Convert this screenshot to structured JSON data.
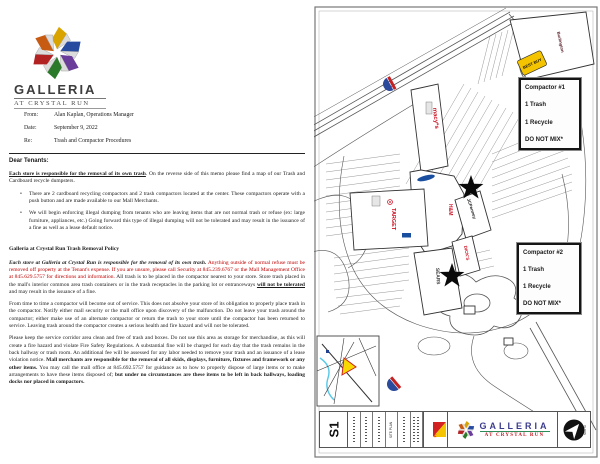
{
  "colors": {
    "memo_red": "#c00000",
    "store_red": "#cc1122",
    "label_blue": "#1a4fa0",
    "bestbuy_yellow": "#f5c400",
    "shield_blue": "#2b4a9b",
    "shield_red": "#c42222",
    "galleria_blue": "#3c3c8e",
    "galleria_green": "#2e8b57",
    "crystal_run_red": "#c01820",
    "pyramid_red": "#d42222",
    "pyramid_yellow": "#f5c400"
  },
  "memo": {
    "logo": {
      "name": "GALLERIA",
      "tagline": "AT CRYSTAL RUN"
    },
    "fields": {
      "from_label": "From:",
      "from": "Alan Kaplan, Operations Manager",
      "date_label": "Date:",
      "date": "September 9, 2022",
      "re_label": "Re:",
      "re": "Trash and Compactor Procedures"
    },
    "salutation": "Dear Tenants:",
    "intro_bold": "Each store is responsible for the removal of its own trash",
    "intro_rest": ".  On the reverse side of this memo please find a map of our Trash and Cardboard  recycle dumpsters.",
    "bullet1": "There are 2 cardboard recycling compactors and 2 trash compactors located at the center.  These compactors operate with a push button and are made available to our Mall Merchants.",
    "bullet2": "We will begin enforcing illegal dumping from tenants who are leaving items that are not normal trash or refuse (ex: large furniture, appliances, etc.) Going forward this type of illegal dumping will not be tolerated and may result in the issuance of a fine as well as a lease default notice.",
    "policy_heading": "Galleria at Crystal Run Trash Removal Policy",
    "policy": {
      "lead_bold_italic": "Each store at Galleria at Crystal Run is responsible for the removal of its own trash.",
      "red_text": " Anything outside of normal refuse must be removed off property at the Tenant's expense. If you are unsure, please call Security at 845.239.6767 or the Mall Management Office at 845.629.5757 for directions and information.",
      "body1": " All trash is to be placed in the compactor nearest to your store. Store trash placed in the mall's interior common area trash containers or in the trash receptacles in  the parking lot or entranceways ",
      "bold_underline": "will not be tolerated",
      "body2": " and may result in the issuance of a fine."
    },
    "out_of_service": "From time to time a  compactor will become out of service. This does not absolve your store of  its obligation to properly place trash in the compactor. Notify either mall security or the mall office upon discovery of the malfunction. Do not leave your trash around the compactor; either make use of an alternate compactor or return the trash to your store until the compactor has been returned to service. Leaving trash around the compactor creates a serious health and fire hazard and will not be tolerated.",
    "corridor": {
      "body1": "Please keep the service corridor area clean and  free of trash and boxes. Do not use this area as storage for merchandise, as this will create a fire hazard and violate  Fire Safety Regulations. A substantial fine will be charged for each day that the trash remains in the back hallway  or trash room. An additional fee will be assessed for any labor needed to remove your trash and an issuance of a  lease violation notice. ",
      "bold1": "Mall merchants are responsible for the removal of all skids, displays, furniture, fixtures  and framework or any other items.",
      "body2": " You may call the mall office at 845.692.5757 for guidance as to how to properly dispose of large items or to make arrangements to have these items disposed of; ",
      "bold2": "but under no circumstances are these items to be left in back hallways, loading docks nor placed in compactors."
    }
  },
  "map": {
    "compactor1": {
      "title": "Compactor #1",
      "trash": "1 Trash",
      "recycle": "1 Recycle",
      "warning": "DO NOT MIX*"
    },
    "compactor2": {
      "title": "Compactor #2",
      "trash": "1 Trash",
      "recycle": "1 Recycle",
      "warning": "DO NOT MIX*"
    },
    "stores": {
      "macys": "macy*s",
      "target": "TARGET",
      "hm": "H&M",
      "jcpenney": "JCPenney",
      "dicks": "DICK'S",
      "sears": "SEARS",
      "burlington": "Burlington",
      "bestbuy": "BEST BUY"
    },
    "titleblock": {
      "sheet": "S1",
      "drawing": "SITE PLAN",
      "firm": "PYRAMID",
      "logo_name": "GALLERIA",
      "logo_tagline": "AT CRYSTAL RUN",
      "north": "NORTH"
    }
  }
}
